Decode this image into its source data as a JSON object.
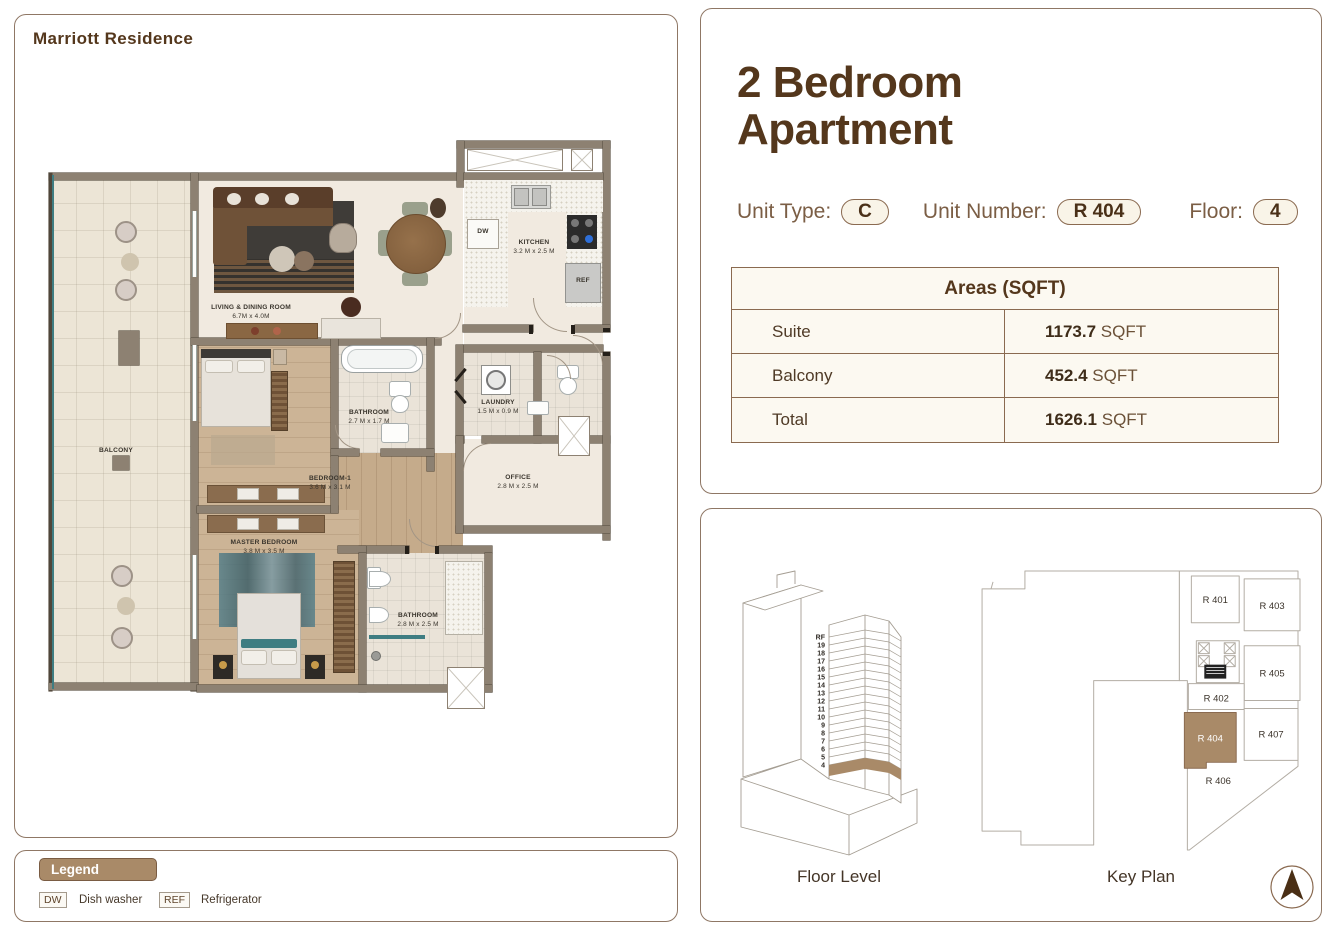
{
  "brand": "Marriott Residence",
  "title": {
    "line1": "2 Bedroom",
    "line2": "Apartment"
  },
  "unit_info": {
    "type_label": "Unit Type:",
    "type_value": "C",
    "number_label": "Unit Number:",
    "number_value": "R 404",
    "floor_label": "Floor:",
    "floor_value": "4"
  },
  "areas_table": {
    "header": "Areas (SQFT)",
    "rows": [
      {
        "label": "Suite",
        "value": "1173.7",
        "unit": "SQFT"
      },
      {
        "label": "Balcony",
        "value": "452.4",
        "unit": "SQFT"
      },
      {
        "label": "Total",
        "value": "1626.1",
        "unit": "SQFT"
      }
    ]
  },
  "floor_plan": {
    "rooms": [
      {
        "name": "BALCONY",
        "dims": ""
      },
      {
        "name": "LIVING & DINING ROOM",
        "dims": "6.7M x 4.0M"
      },
      {
        "name": "KITCHEN",
        "dims": "3.2 M x 2.5 M"
      },
      {
        "name": "BATHROOM",
        "dims": "2.7 M x 1.7 M"
      },
      {
        "name": "LAUNDRY",
        "dims": "1.5 M x 0.9 M"
      },
      {
        "name": "OFFICE",
        "dims": "2.8 M x 2.5 M"
      },
      {
        "name": "BEDROOM-1",
        "dims": "3.6 M x 3.1 M"
      },
      {
        "name": "MASTER BEDROOM",
        "dims": "3.8 M x 3.5 M"
      },
      {
        "name": "BATHROOM",
        "dims": "2.8 M x 2.5 M"
      }
    ],
    "appliances": {
      "dw": "DW",
      "ref": "REF"
    }
  },
  "legend": {
    "title": "Legend",
    "items": [
      {
        "abbr": "DW",
        "label": "Dish washer"
      },
      {
        "abbr": "REF",
        "label": "Refrigerator"
      }
    ]
  },
  "floor_level": {
    "caption": "Floor Level",
    "floors": [
      "RF",
      "19",
      "18",
      "17",
      "16",
      "15",
      "14",
      "13",
      "12",
      "11",
      "10",
      "9",
      "8",
      "7",
      "6",
      "5",
      "4"
    ],
    "highlighted": "4"
  },
  "key_plan": {
    "caption": "Key Plan",
    "units": [
      "R 401",
      "R 403",
      "R 405",
      "R 402",
      "R 404",
      "R 407",
      "R 406"
    ],
    "highlighted": "R 404"
  },
  "colors": {
    "accent": "#a98a68",
    "dark_brown": "#54371c",
    "wall": "#8d8172"
  }
}
